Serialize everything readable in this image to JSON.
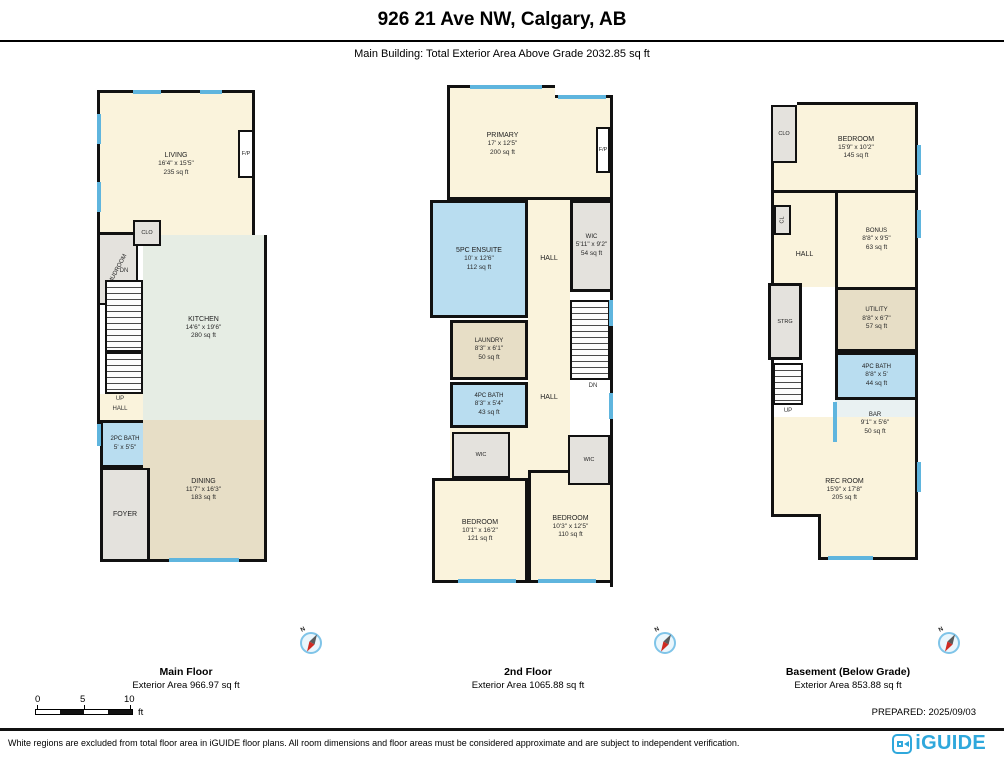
{
  "header": {
    "title": "926 21 Ave NW, Calgary, AB",
    "subtitle": "Main Building: Total Exterior Area Above Grade 2032.85 sq ft"
  },
  "plans": [
    {
      "name": "Main Floor",
      "area_label": "Exterior Area 966.97 sq ft",
      "rooms": {
        "living": {
          "name": "LIVING",
          "dims": "16'4\" x 15'5\"",
          "area": "235 sq ft"
        },
        "fp": {
          "name": "F/P"
        },
        "clo": {
          "name": "CLO"
        },
        "mudroom": {
          "name": "MUDROOM"
        },
        "dn": {
          "name": "DN"
        },
        "up": {
          "name": "UP"
        },
        "hall": {
          "name": "HALL"
        },
        "kitchen": {
          "name": "KITCHEN",
          "dims": "14'6\" x 19'6\"",
          "area": "280 sq ft"
        },
        "bath2pc": {
          "name": "2PC BATH",
          "dims": "5' x 5'5\""
        },
        "dining": {
          "name": "DINING",
          "dims": "11'7\" x 16'3\"",
          "area": "183 sq ft"
        },
        "foyer": {
          "name": "FOYER"
        }
      }
    },
    {
      "name": "2nd Floor",
      "area_label": "Exterior Area 1065.88 sq ft",
      "rooms": {
        "primary": {
          "name": "PRIMARY",
          "dims": "17' x 12'5\"",
          "area": "200 sq ft"
        },
        "fp": {
          "name": "F/P"
        },
        "ensuite": {
          "name": "5PC ENSUITE",
          "dims": "10' x 12'6\"",
          "area": "112 sq ft"
        },
        "hall_upper": {
          "name": "HALL"
        },
        "wic_upper": {
          "name": "WIC",
          "dims": "5'11\" x 9'2\"",
          "area": "54 sq ft"
        },
        "dn": {
          "name": "DN"
        },
        "laundry": {
          "name": "LAUNDRY",
          "dims": "8'3\" x 6'1\"",
          "area": "50 sq ft"
        },
        "bath4pc": {
          "name": "4PC BATH",
          "dims": "8'3\" x 5'4\"",
          "area": "43 sq ft"
        },
        "hall_lower": {
          "name": "HALL"
        },
        "wic_left": {
          "name": "WIC"
        },
        "wic_right": {
          "name": "WIC"
        },
        "bedroom_left": {
          "name": "BEDROOM",
          "dims": "10'1\" x 16'2\"",
          "area": "121 sq ft"
        },
        "bedroom_right": {
          "name": "BEDROOM",
          "dims": "10'3\" x 12'5\"",
          "area": "110 sq ft"
        }
      }
    },
    {
      "name": "Basement (Below Grade)",
      "area_label": "Exterior Area 853.88 sq ft",
      "rooms": {
        "clo": {
          "name": "CLO"
        },
        "bedroom": {
          "name": "BEDROOM",
          "dims": "15'9\" x 10'2\"",
          "area": "145 sq ft"
        },
        "cl": {
          "name": "CL"
        },
        "hall": {
          "name": "HALL"
        },
        "bonus": {
          "name": "BONUS",
          "dims": "8'8\" x 9'5\"",
          "area": "63 sq ft"
        },
        "strg": {
          "name": "STRG"
        },
        "utility": {
          "name": "UTILITY",
          "dims": "8'8\" x 6'7\"",
          "area": "57 sq ft"
        },
        "bath4pc": {
          "name": "4PC BATH",
          "dims": "8'8\" x 5'",
          "area": "44 sq ft"
        },
        "bar": {
          "name": "BAR",
          "dims": "9'1\" x 5'6\"",
          "area": "50 sq ft"
        },
        "up": {
          "name": "UP"
        },
        "rec": {
          "name": "REC ROOM",
          "dims": "15'9\" x 17'8\"",
          "area": "205 sq ft"
        }
      }
    }
  ],
  "compass": {
    "label": "N"
  },
  "scale": {
    "ticks": [
      "0",
      "5",
      "10"
    ],
    "unit": "ft"
  },
  "footer": {
    "prepared": "PREPARED: 2025/09/03",
    "disclaimer": "White regions are excluded from total floor area in iGUIDE floor plans. All room dimensions and floor areas must be considered approximate and are subject to independent verification.",
    "logo_text": "iGUIDE"
  },
  "colors": {
    "wall": "#111111",
    "window": "#5FB5DE",
    "accent": "#2FA8DC",
    "room_cream": "#FAF3DC",
    "room_tan": "#E7DEC6",
    "room_blue": "#B9DDF0",
    "room_gray": "#E4E2DD",
    "room_green": "#E6EDE4",
    "room_pale": "#E9F1F2"
  }
}
